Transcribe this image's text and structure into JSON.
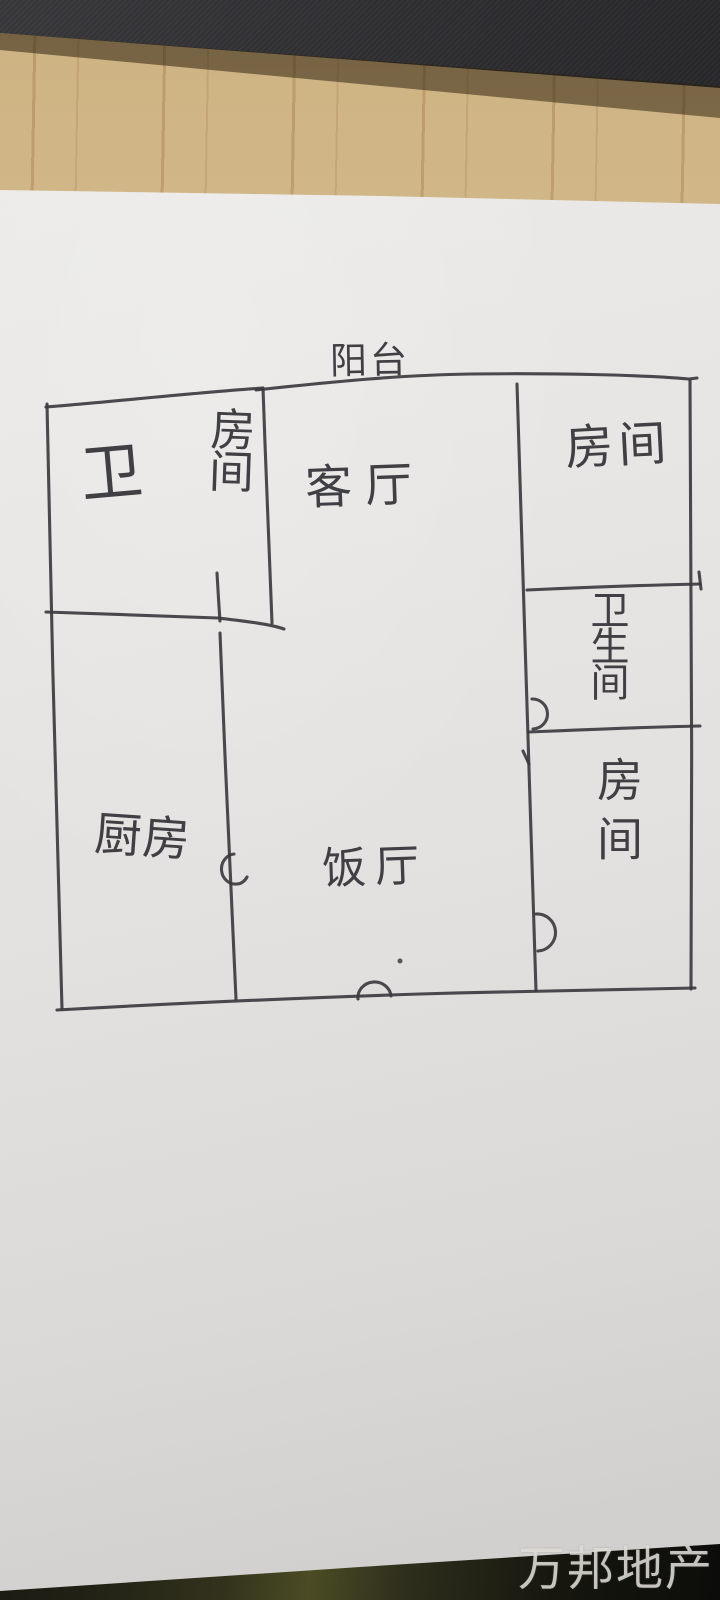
{
  "photo": {
    "description": "hand-drawn apartment floor plan on white paper, photographed on a wooden desk",
    "rooms": [
      {
        "name": "balcony",
        "label": "阳台",
        "orientation": "horizontal"
      },
      {
        "name": "toilet",
        "label": "卫",
        "orientation": "horizontal"
      },
      {
        "name": "bedroom-top-left",
        "label": "房间",
        "orientation": "vertical"
      },
      {
        "name": "living-room",
        "label": "客厅",
        "orientation": "horizontal"
      },
      {
        "name": "bedroom-top-right",
        "label": "房间",
        "orientation": "horizontal"
      },
      {
        "name": "bathroom",
        "label": "卫生间",
        "orientation": "vertical"
      },
      {
        "name": "bedroom-bottom-right",
        "label": "房间",
        "orientation": "vertical"
      },
      {
        "name": "kitchen",
        "label": "厨房",
        "orientation": "horizontal"
      },
      {
        "name": "dining-room",
        "label": "饭厅",
        "orientation": "horizontal"
      }
    ],
    "watermark": "万邦地产",
    "colors": {
      "ink": "#3c3b3f",
      "paper": "#e6e4e2",
      "wood": "#d9c394",
      "dark_object": "#2b2a2d",
      "dark_table_edge": "#1c1c12",
      "watermark_text": "#e2dfd9"
    }
  }
}
